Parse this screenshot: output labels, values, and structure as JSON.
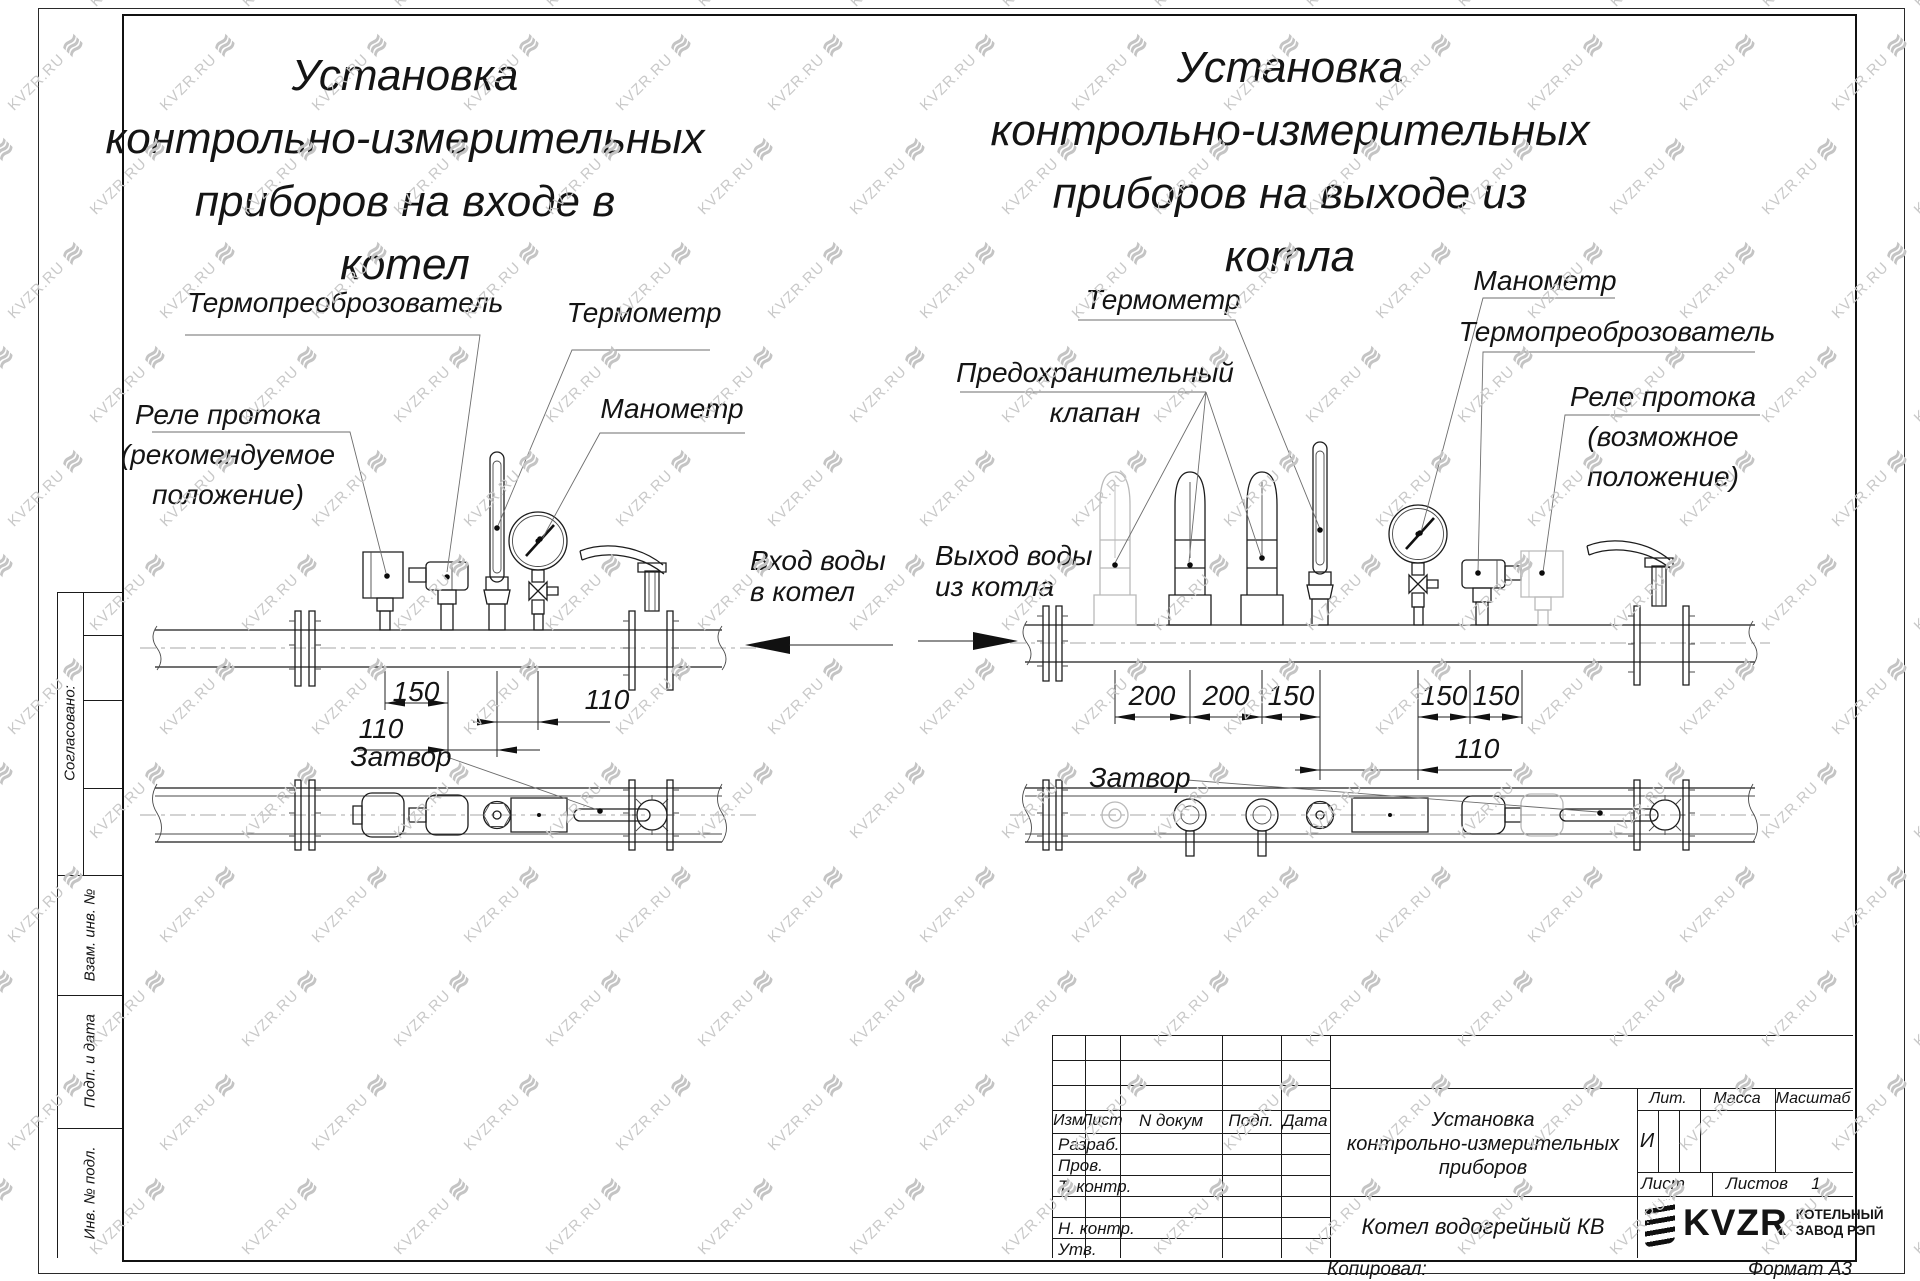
{
  "watermark": {
    "text": "KVZR.RU",
    "glyph": "≋"
  },
  "titles": {
    "left": "Установка\nконтрольно-измерительных\nприборов на входе в\nкотел",
    "right": "Установка\nконтрольно-измерительных\nприборов на выходе из\nкотла"
  },
  "labels": {
    "left": {
      "thermo_transducer": "Термопреоброзователь",
      "thermometer": "Термометр",
      "manometer": "Манометр",
      "flow_relay": "Реле протока\n(рекомендуемое\nположение)",
      "valve": "Затвор"
    },
    "right": {
      "thermometer": "Термометр",
      "safety_valve": "Предохранительный\nклапан",
      "manometer": "Манометр",
      "thermo_transducer": "Термопреоброзователь",
      "flow_relay": "Реле протока\n(возможное\nположение)",
      "valve": "Затвор"
    }
  },
  "flow": {
    "inlet": "Вход воды\nв котел",
    "outlet": "Выход воды\nиз котла"
  },
  "dimensions": {
    "left": [
      "150",
      "110",
      "110"
    ],
    "right": [
      "200",
      "200",
      "150",
      "150",
      "150",
      "110"
    ]
  },
  "sidebar": {
    "agreed": "Согласовано:",
    "vzam": "Взам. инв. №",
    "podp_data": "Подп. и дата",
    "inv": "Инв. № подл."
  },
  "title_block": {
    "izm": "Изм",
    "list": "Лист",
    "ndokum": "N докум",
    "podp": "Подп.",
    "data_col": "Дата",
    "razrab": "Разраб.",
    "prov": "Пров.",
    "tkontr": "Т. контр.",
    "nkontr": "Н. контр.",
    "utv": "Утв.",
    "doc_title": "Установка\nконтрольно-измерительных\nприборов",
    "product": "Котел водогрейный КВ",
    "lit": "Лит.",
    "mass": "Масса",
    "scale": "Масштаб",
    "lit_value": "И",
    "sheet": "Лист",
    "sheets": "Листов",
    "sheets_value": "1"
  },
  "logo": {
    "name": "KVZR",
    "sub1": "КОТЕЛЬНЫЙ",
    "sub2": "ЗАВОД РЭП"
  },
  "footer": {
    "copied": "Копировал:",
    "format": "Формат А3"
  }
}
